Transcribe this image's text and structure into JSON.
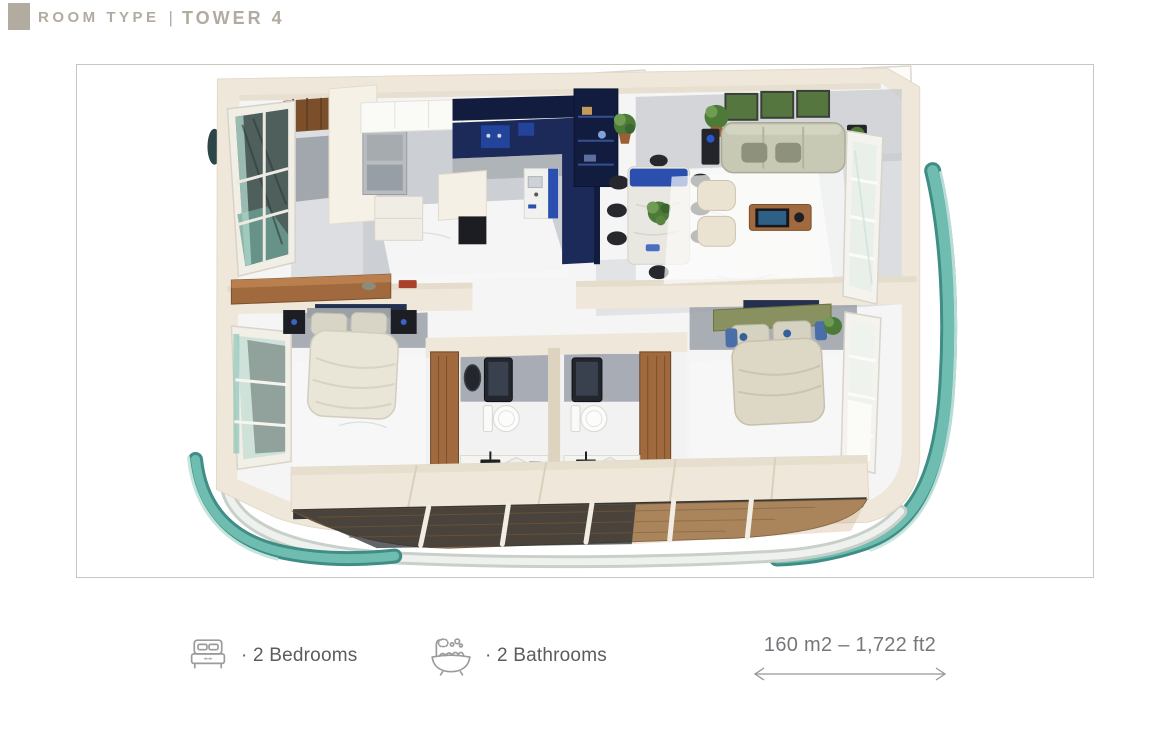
{
  "header": {
    "title": "ROOM TYPE",
    "separator": "|",
    "subtitle": "TOWER 4"
  },
  "features": {
    "bedrooms": {
      "icon": "bed-icon",
      "label": "· 2 Bedrooms"
    },
    "bathrooms": {
      "icon": "bathtub-icon",
      "label": "· 2 Bathrooms"
    }
  },
  "area": {
    "text": "160 m2 – 1,722 ft2"
  },
  "colors": {
    "header-accent": "#b2aba0",
    "feature-text": "#5a5c60",
    "area-text": "#75777b",
    "icon-stroke": "#9b9c9a",
    "arrow-stroke": "#97989a",
    "frame-border": "#c9c5bf",
    "wall": "#efe8da",
    "wall-dark": "#ded3bf",
    "floor": "#f5f5f6",
    "floor-gray": "#9ba1a9",
    "floor-gray2": "#c4c8cd",
    "marble-line": "#dadcdf",
    "navy": "#1c2a5a",
    "navy-dark": "#121c3e",
    "blue-accent": "#2a4fae",
    "teal": "#6fbcb1",
    "teal-dark": "#3f8d84",
    "teal-light": "#c4e4de",
    "wood": "#a06a3e",
    "wood-dark": "#7c4f2b",
    "sage": "#c7c9b4",
    "olive": "#8a9160",
    "linen": "#e9e5d7",
    "dark": "#1d1f24",
    "green": "#4d7a38",
    "deck": "#9c7850"
  }
}
